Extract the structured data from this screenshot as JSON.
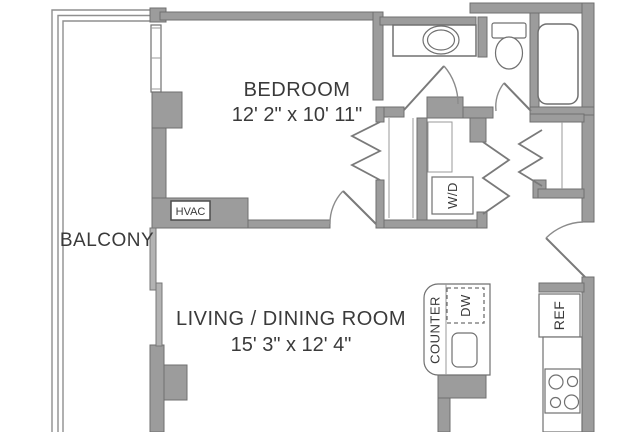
{
  "rooms": {
    "bedroom": {
      "label": "BEDROOM",
      "dimensions": "12' 2\" x 10' 11\""
    },
    "living_dining": {
      "label": "LIVING / DINING ROOM",
      "dimensions": "15' 3\" x 12' 4\""
    },
    "balcony": {
      "label": "BALCONY"
    }
  },
  "fixtures": {
    "hvac": "HVAC",
    "washer_dryer": "W/D",
    "counter": "COUNTER",
    "dishwasher": "DW",
    "refrigerator": "REF"
  },
  "colors": {
    "wall": "#9c9c9c",
    "wall_outline": "#6f6f6f",
    "fixture_line": "#707070",
    "text": "#3a3a3a",
    "background": "#ffffff"
  }
}
